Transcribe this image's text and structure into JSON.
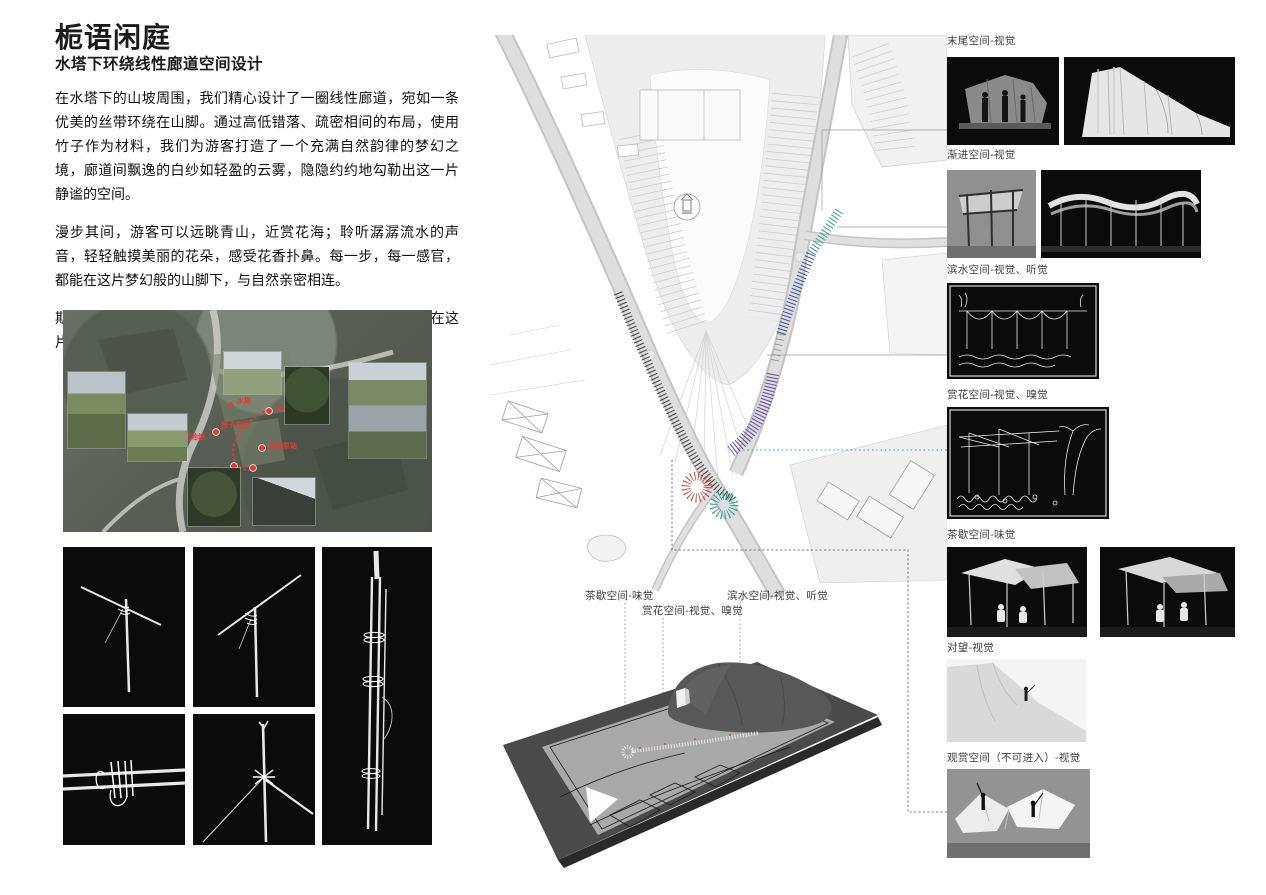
{
  "poster": {
    "title": "栀语闲庭",
    "subtitle": "水塔下环绕线性廊道空间设计",
    "paragraphs": [
      "在水塔下的山坡周围，我们精心设计了一圈线性廊道，宛如一条优美的丝带环绕在山脚。通过高低错落、疏密相间的布局，使用竹子作为材料，我们为游客打造了一个充满自然韵律的梦幻之境，廊道间飘逸的白纱如轻盈的云雾，隐隐约约地勾勒出这一片静谧的空间。",
      "漫步其间，游客可以远眺青山，近赏花海；聆听潺潺流水的声音，轻轻触摸美丽的花朵，感受花香扑鼻。每一步，每一感官，都能在这片梦幻般的山脚下，与自然亲密相连。",
      "期待在下一个栀子花盛开的季节，能够让每一位来访者都能在这片宁静美丽的空间里，找到内心的平和与宁静。"
    ]
  },
  "aerial": {
    "marker_color": "#e8392e",
    "labels": {
      "water_tower": "水塔",
      "big_tree": "大树",
      "gardenia_field": "栀子花田",
      "lotus_pond": "荷花池塘",
      "pump_station": "废弃泵站",
      "canal": "大水渠"
    }
  },
  "site_plan": {
    "tick_colors": {
      "walk": "#2e2e2e",
      "teal": "#2f9e8f",
      "blue": "#3d4fa1",
      "purple": "#6b4d9e",
      "red": "#c0544d",
      "cyan": "#2fa39b"
    }
  },
  "model_section": {
    "labels": {
      "tea": "茶歇空间-味觉",
      "flower": "赏花空间-视觉、嗅觉",
      "water": "滨水空间-视觉、听觉"
    }
  },
  "right": {
    "sections": [
      {
        "label": "末尾空间-视觉"
      },
      {
        "label": "渐进空间-视觉"
      },
      {
        "label": "滨水空间-视觉、听觉"
      },
      {
        "label": "赏花空间-视觉、嗅觉"
      },
      {
        "label": "茶歇空间-味觉"
      },
      {
        "label": "对望-视觉"
      },
      {
        "label": "观赏空间（不可进入）-视觉"
      }
    ]
  }
}
